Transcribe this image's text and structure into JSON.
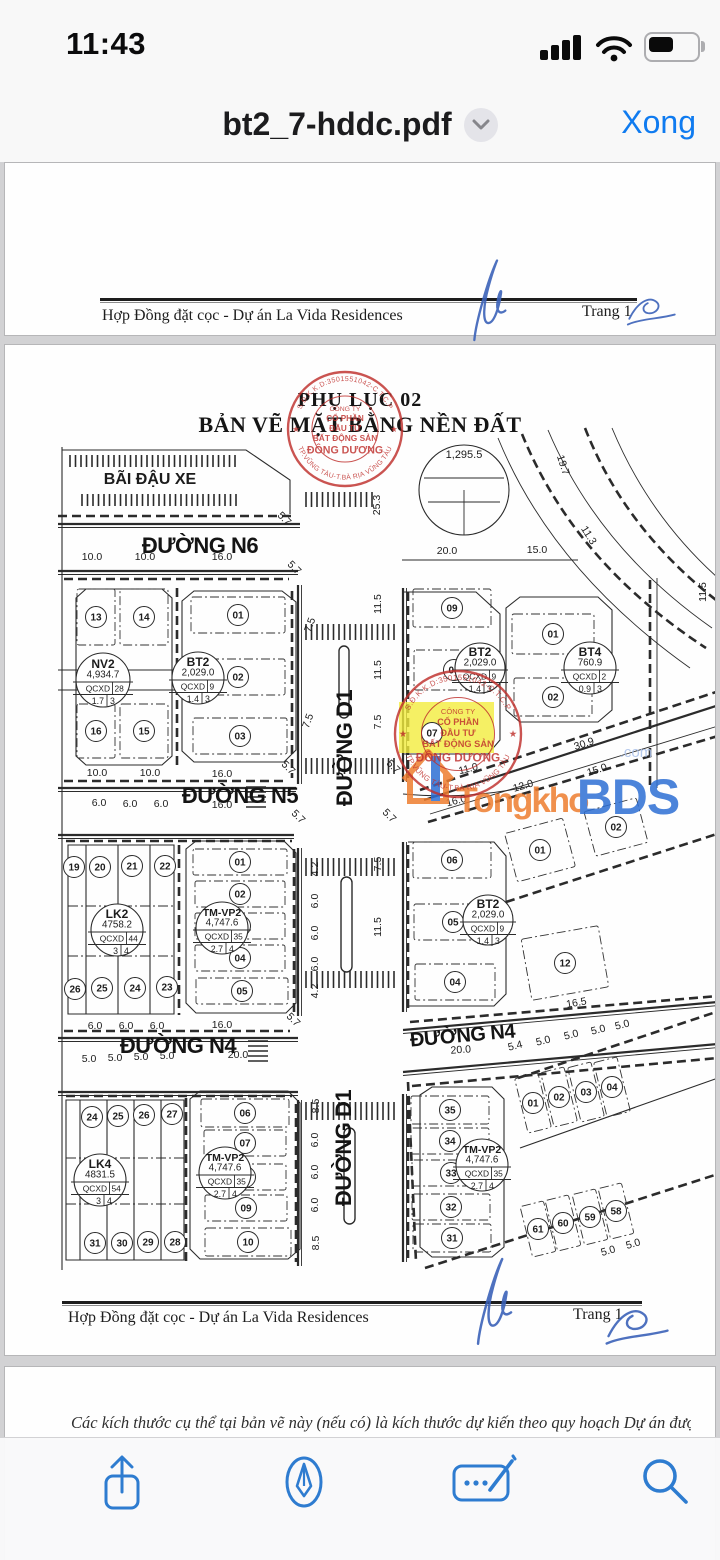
{
  "status_bar": {
    "time": "11:43"
  },
  "nav_bar": {
    "title": "bt2_7-hddc.pdf",
    "done_label": "Xong"
  },
  "toolbar": {
    "icons": [
      "share-icon",
      "markup-pen-icon",
      "signature-icon",
      "search-icon"
    ]
  },
  "pages": {
    "top": {
      "footer_left": "Hợp Đồng đặt cọc - Dự án La Vida Residences",
      "footer_right": "Trang 1"
    },
    "main": {
      "footer_left": "Hợp Đồng đặt cọc - Dự án La Vida Residences",
      "footer_right": "Trang 1"
    },
    "bottom": {
      "text": "Các kích thước cụ thể tại bản vẽ này (nếu có) là kích thước dự kiến theo quy hoạch Dự án được phê"
    }
  },
  "plan": {
    "title_line1": "PHỤ LỤC 02",
    "title_line2": "BẢN VẼ MẶT BẰNG NỀN ĐẤT",
    "stamp": {
      "ring_top": "S.Đ.K.K.D:3501551042-C.T.C.P",
      "ring_bottom": "TP.VŨNG TÀU-T.BÀ RỊA VŨNG TÀU",
      "center": [
        "CÔNG TY",
        "CỔ PHẦN",
        "ĐẦU TƯ",
        "BẤT ĐỘNG SẢN",
        "ĐÔNG DƯƠNG"
      ]
    },
    "watermark": {
      "name": "Tongkho",
      "suffix": "BDS",
      "tld": ".com"
    },
    "road_labels": [
      {
        "t": "ĐƯỜNG N6",
        "x": 200,
        "y": 553,
        "r": 0,
        "s": 22
      },
      {
        "t": "ĐƯỜNG N5",
        "x": 240,
        "y": 803,
        "r": 0,
        "s": 22
      },
      {
        "t": "ĐƯỜNG N4",
        "x": 178,
        "y": 1053,
        "r": 0,
        "s": 22
      },
      {
        "t": "ĐƯỜNG N4",
        "x": 463,
        "y": 1042,
        "r": -5,
        "s": 20
      },
      {
        "t": "ĐƯỜNG D1",
        "x": 352,
        "y": 748,
        "r": -90,
        "s": 22
      },
      {
        "t": "ĐƯỜNG D1",
        "x": 351,
        "y": 1148,
        "r": -90,
        "s": 22
      }
    ],
    "misc_labels": [
      {
        "t": "BÃI ĐẬU XE",
        "x": 150,
        "y": 484,
        "s": 16,
        "b": 1
      },
      {
        "t": "1,295.5",
        "x": 464,
        "y": 458,
        "s": 11,
        "b": 0
      }
    ],
    "block_labels": [
      {
        "name": "NV2",
        "area": "4,934.7",
        "qcxd": "QCXD",
        "lots": "28",
        "r1": "1.7",
        "r2": "3",
        "x": 103,
        "y": 680,
        "cr": 27
      },
      {
        "name": "BT2",
        "area": "2,029.0",
        "qcxd": "QCXD",
        "lots": "9",
        "r1": "1.4",
        "r2": "3",
        "x": 198,
        "y": 678,
        "cr": 26
      },
      {
        "name": "BT2",
        "area": "2,029.0",
        "qcxd": "QCXD",
        "lots": "9",
        "r1": "1.4",
        "r2": "3",
        "x": 480,
        "y": 668,
        "cr": 25
      },
      {
        "name": "BT4",
        "area": "760.9",
        "qcxd": "QCXD",
        "lots": "2",
        "r1": "0.9",
        "r2": "3",
        "x": 590,
        "y": 668,
        "cr": 26
      },
      {
        "name": "LK2",
        "area": "4758.2",
        "qcxd": "QCXD",
        "lots": "44",
        "r1": "3",
        "r2": "4",
        "x": 117,
        "y": 930,
        "cr": 26
      },
      {
        "name": "TM-VP2",
        "area": "4,747.6",
        "qcxd": "QCXD",
        "lots": "35",
        "r1": "2.7",
        "r2": "4",
        "x": 222,
        "y": 928,
        "cr": 26
      },
      {
        "name": "BT2",
        "area": "2,029.0",
        "qcxd": "QCXD",
        "lots": "9",
        "r1": "1.4",
        "r2": "3",
        "x": 488,
        "y": 920,
        "cr": 25
      },
      {
        "name": "LK4",
        "area": "4831.5",
        "qcxd": "QCXD",
        "lots": "54",
        "r1": "3",
        "r2": "4",
        "x": 100,
        "y": 1180,
        "cr": 26
      },
      {
        "name": "TM-VP2",
        "area": "4,747.6",
        "qcxd": "QCXD",
        "lots": "35",
        "r1": "2.7",
        "r2": "4",
        "x": 225,
        "y": 1173,
        "cr": 26
      },
      {
        "name": "TM-VP2",
        "area": "4,747.6",
        "qcxd": "QCXD",
        "lots": "35",
        "r1": "2.7",
        "r2": "4",
        "x": 482,
        "y": 1165,
        "cr": 26
      }
    ],
    "plots": [
      {
        "n": "13",
        "x": 96,
        "y": 617,
        "w": 38,
        "h": 56
      },
      {
        "n": "14",
        "x": 144,
        "y": 617,
        "w": 48,
        "h": 56
      },
      {
        "n": "16",
        "x": 96,
        "y": 731,
        "w": 38,
        "h": 54
      },
      {
        "n": "15",
        "x": 144,
        "y": 731,
        "w": 48,
        "h": 54
      },
      {
        "n": "01",
        "x": 238,
        "y": 615,
        "w": 94,
        "h": 36
      },
      {
        "n": "02",
        "x": 238,
        "y": 677,
        "w": 94,
        "h": 36
      },
      {
        "n": "03",
        "x": 240,
        "y": 736,
        "w": 94,
        "h": 36
      },
      {
        "n": "09",
        "x": 452,
        "y": 608,
        "w": 78,
        "h": 38
      },
      {
        "n": "08",
        "x": 454,
        "y": 670,
        "w": 80,
        "h": 40
      },
      {
        "n": "07",
        "x": 432,
        "y": 733
      },
      {
        "n": "01",
        "x": 553,
        "y": 634,
        "w": 82,
        "h": 40
      },
      {
        "n": "02",
        "x": 553,
        "y": 697,
        "w": 78,
        "h": 38
      },
      {
        "n": "06",
        "x": 452,
        "y": 860,
        "w": 78,
        "h": 36
      },
      {
        "n": "05",
        "x": 453,
        "y": 922,
        "w": 78,
        "h": 36
      },
      {
        "n": "04",
        "x": 455,
        "y": 982,
        "w": 80,
        "h": 36
      },
      {
        "n": "01",
        "x": 540,
        "y": 850,
        "w": 60,
        "h": 50,
        "r": -15
      },
      {
        "n": "02",
        "x": 616,
        "y": 827,
        "w": 54,
        "h": 46,
        "r": -15
      },
      {
        "n": "12",
        "x": 565,
        "y": 963,
        "w": 78,
        "h": 62,
        "r": -10
      },
      {
        "n": "19",
        "x": 74,
        "y": 867
      },
      {
        "n": "20",
        "x": 100,
        "y": 867
      },
      {
        "n": "21",
        "x": 132,
        "y": 866
      },
      {
        "n": "22",
        "x": 165,
        "y": 866
      },
      {
        "n": "26",
        "x": 75,
        "y": 989
      },
      {
        "n": "25",
        "x": 102,
        "y": 988
      },
      {
        "n": "24",
        "x": 135,
        "y": 988
      },
      {
        "n": "23",
        "x": 167,
        "y": 987
      },
      {
        "n": "01",
        "x": 240,
        "y": 862,
        "w": 94,
        "h": 26
      },
      {
        "n": "02",
        "x": 240,
        "y": 894,
        "w": 90,
        "h": 26
      },
      {
        "n": "03",
        "x": 240,
        "y": 926,
        "w": 90,
        "h": 26
      },
      {
        "n": "04",
        "x": 240,
        "y": 958,
        "w": 90,
        "h": 26
      },
      {
        "n": "05",
        "x": 242,
        "y": 991,
        "w": 92,
        "h": 26
      },
      {
        "n": "24",
        "x": 92,
        "y": 1117
      },
      {
        "n": "25",
        "x": 118,
        "y": 1116
      },
      {
        "n": "26",
        "x": 144,
        "y": 1115
      },
      {
        "n": "27",
        "x": 172,
        "y": 1114
      },
      {
        "n": "31",
        "x": 95,
        "y": 1243
      },
      {
        "n": "30",
        "x": 122,
        "y": 1243
      },
      {
        "n": "29",
        "x": 148,
        "y": 1242
      },
      {
        "n": "28",
        "x": 175,
        "y": 1242
      },
      {
        "n": "06",
        "x": 245,
        "y": 1113,
        "w": 88,
        "h": 28
      },
      {
        "n": "07",
        "x": 245,
        "y": 1143,
        "w": 82,
        "h": 26
      },
      {
        "n": "08",
        "x": 245,
        "y": 1177,
        "w": 82,
        "h": 26
      },
      {
        "n": "09",
        "x": 246,
        "y": 1208,
        "w": 82,
        "h": 26
      },
      {
        "n": "10",
        "x": 248,
        "y": 1242,
        "w": 86,
        "h": 28
      },
      {
        "n": "35",
        "x": 450,
        "y": 1110,
        "w": 78,
        "h": 28
      },
      {
        "n": "34",
        "x": 450,
        "y": 1141,
        "w": 78,
        "h": 26
      },
      {
        "n": "33",
        "x": 451,
        "y": 1173,
        "w": 78,
        "h": 26
      },
      {
        "n": "32",
        "x": 451,
        "y": 1207,
        "w": 78,
        "h": 26
      },
      {
        "n": "31",
        "x": 452,
        "y": 1238,
        "w": 78,
        "h": 28
      },
      {
        "n": "01",
        "x": 533,
        "y": 1103,
        "w": 24,
        "h": 56,
        "r": -14
      },
      {
        "n": "02",
        "x": 559,
        "y": 1097,
        "w": 24,
        "h": 56,
        "r": -14
      },
      {
        "n": "03",
        "x": 586,
        "y": 1092,
        "w": 24,
        "h": 56,
        "r": -14
      },
      {
        "n": "04",
        "x": 612,
        "y": 1087,
        "w": 24,
        "h": 56,
        "r": -14
      },
      {
        "n": "61",
        "x": 538,
        "y": 1229,
        "w": 24,
        "h": 52,
        "r": -14
      },
      {
        "n": "60",
        "x": 563,
        "y": 1223,
        "w": 24,
        "h": 52,
        "r": -14
      },
      {
        "n": "59",
        "x": 590,
        "y": 1217,
        "w": 24,
        "h": 52,
        "r": -14
      },
      {
        "n": "58",
        "x": 616,
        "y": 1211,
        "w": 24,
        "h": 52,
        "r": -14
      }
    ],
    "dims": [
      {
        "t": "10.0",
        "x": 92,
        "y": 560
      },
      {
        "t": "10.0",
        "x": 145,
        "y": 560
      },
      {
        "t": "16.0",
        "x": 222,
        "y": 560
      },
      {
        "t": "5.7",
        "x": 282,
        "y": 521,
        "r": 45
      },
      {
        "t": "5.7",
        "x": 292,
        "y": 570,
        "r": 45
      },
      {
        "t": "25.3",
        "x": 380,
        "y": 505,
        "r": -90
      },
      {
        "t": "20.0",
        "x": 447,
        "y": 554
      },
      {
        "t": "15.0",
        "x": 537,
        "y": 553
      },
      {
        "t": "19.7",
        "x": 560,
        "y": 466,
        "r": 72
      },
      {
        "t": "11.3",
        "x": 586,
        "y": 537,
        "r": 58
      },
      {
        "t": "11.5",
        "x": 706,
        "y": 592,
        "r": -90
      },
      {
        "t": "7.5",
        "x": 313,
        "y": 626,
        "r": -70
      },
      {
        "t": "11.5",
        "x": 381,
        "y": 604,
        "r": -90
      },
      {
        "t": "11.5",
        "x": 381,
        "y": 670,
        "r": -90
      },
      {
        "t": "7.5",
        "x": 311,
        "y": 722,
        "r": -70
      },
      {
        "t": "7.5",
        "x": 381,
        "y": 722,
        "r": -90
      },
      {
        "t": "10.0",
        "x": 97,
        "y": 776
      },
      {
        "t": "10.0",
        "x": 150,
        "y": 776
      },
      {
        "t": "16.0",
        "x": 222,
        "y": 777
      },
      {
        "t": "5.7",
        "x": 286,
        "y": 770,
        "r": 45
      },
      {
        "t": "5.7",
        "x": 296,
        "y": 819,
        "r": 45
      },
      {
        "t": "5.7",
        "x": 391,
        "y": 769,
        "r": 45
      },
      {
        "t": "5.7",
        "x": 387,
        "y": 818,
        "r": 45
      },
      {
        "t": "6.0",
        "x": 99,
        "y": 806
      },
      {
        "t": "6.0",
        "x": 130,
        "y": 807
      },
      {
        "t": "6.0",
        "x": 161,
        "y": 807
      },
      {
        "t": "16.0",
        "x": 222,
        "y": 808
      },
      {
        "t": "16.0",
        "x": 457,
        "y": 804,
        "r": -14
      },
      {
        "t": "11.0",
        "x": 469,
        "y": 772,
        "r": -14
      },
      {
        "t": "12.0",
        "x": 524,
        "y": 789,
        "r": -16
      },
      {
        "t": "30.9",
        "x": 585,
        "y": 747,
        "r": -18
      },
      {
        "t": "15.0",
        "x": 598,
        "y": 773,
        "r": -18
      },
      {
        "t": "4.2",
        "x": 318,
        "y": 869,
        "r": -90
      },
      {
        "t": "6.0",
        "x": 318,
        "y": 901,
        "r": -90
      },
      {
        "t": "6.0",
        "x": 318,
        "y": 933,
        "r": -90
      },
      {
        "t": "6.0",
        "x": 318,
        "y": 964,
        "r": -90
      },
      {
        "t": "4.2",
        "x": 318,
        "y": 991,
        "r": -90
      },
      {
        "t": "7.5",
        "x": 381,
        "y": 864,
        "r": -90
      },
      {
        "t": "11.5",
        "x": 381,
        "y": 927,
        "r": -90
      },
      {
        "t": "16.5",
        "x": 577,
        "y": 1006,
        "r": -10
      },
      {
        "t": "6.0",
        "x": 95,
        "y": 1029
      },
      {
        "t": "6.0",
        "x": 126,
        "y": 1029
      },
      {
        "t": "6.0",
        "x": 157,
        "y": 1029
      },
      {
        "t": "16.0",
        "x": 222,
        "y": 1028
      },
      {
        "t": "5.7",
        "x": 291,
        "y": 1022,
        "r": 45
      },
      {
        "t": "5.0",
        "x": 89,
        "y": 1062
      },
      {
        "t": "5.0",
        "x": 115,
        "y": 1061
      },
      {
        "t": "5.0",
        "x": 141,
        "y": 1060
      },
      {
        "t": "5.0",
        "x": 167,
        "y": 1059
      },
      {
        "t": "20.0",
        "x": 238,
        "y": 1058
      },
      {
        "t": "5.4",
        "x": 516,
        "y": 1049,
        "r": -14
      },
      {
        "t": "5.0",
        "x": 544,
        "y": 1044,
        "r": -14
      },
      {
        "t": "5.0",
        "x": 572,
        "y": 1038,
        "r": -14
      },
      {
        "t": "5.0",
        "x": 599,
        "y": 1033,
        "r": -14
      },
      {
        "t": "5.0",
        "x": 623,
        "y": 1028,
        "r": -14
      },
      {
        "t": "20.0",
        "x": 461,
        "y": 1053,
        "r": -4
      },
      {
        "t": "8.5",
        "x": 319,
        "y": 1106,
        "r": -90
      },
      {
        "t": "6.0",
        "x": 318,
        "y": 1140,
        "r": -90
      },
      {
        "t": "6.0",
        "x": 318,
        "y": 1172,
        "r": -90
      },
      {
        "t": "6.0",
        "x": 318,
        "y": 1205,
        "r": -90
      },
      {
        "t": "8.5",
        "x": 319,
        "y": 1243,
        "r": -90
      },
      {
        "t": "5.0",
        "x": 609,
        "y": 1254,
        "r": -16
      },
      {
        "t": "5.0",
        "x": 634,
        "y": 1247,
        "r": -16
      }
    ]
  },
  "colors": {
    "ios_blue": "#0f7bf0",
    "icon_blue": "#2e7cd0",
    "stamp_red": "#bf2f2c",
    "highlight_yellow": "#f2ec3d",
    "watermark_orange": "#ee7d2f",
    "watermark_blue": "#2e6fd4",
    "signature_blue": "#3b62b8"
  }
}
